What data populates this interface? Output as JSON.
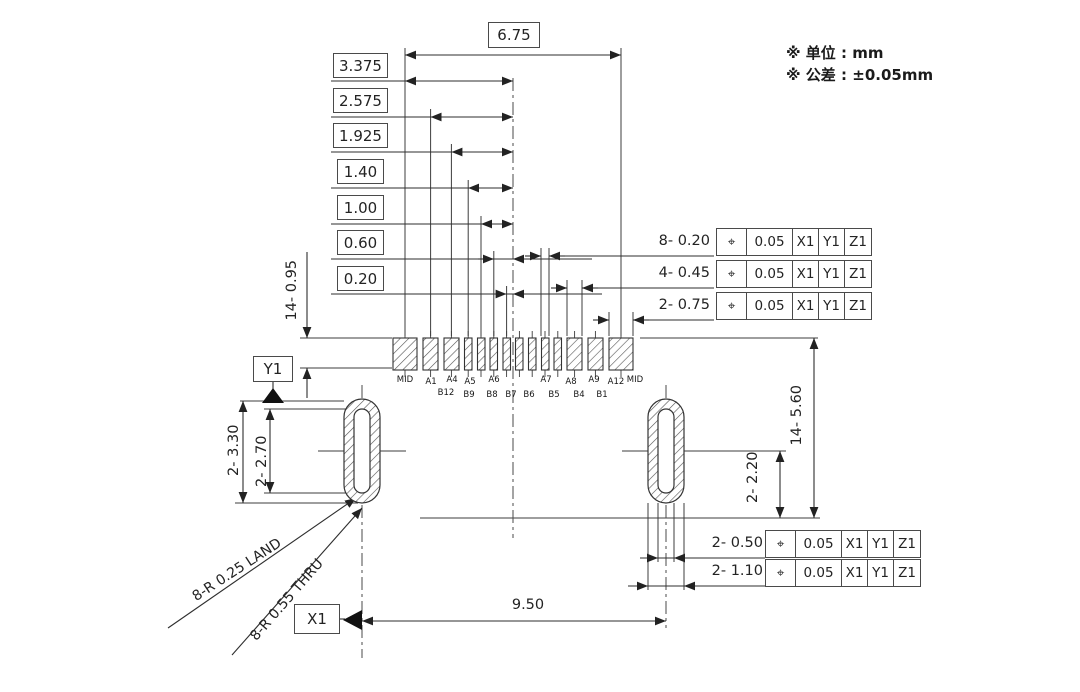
{
  "notes": {
    "unit": "※ 单位 : mm",
    "tolerance": "※ 公差 : ±0.05mm"
  },
  "dims": {
    "top_width": "6.75",
    "stack": [
      "3.375",
      "2.575",
      "1.925",
      "1.40",
      "1.00",
      "0.60",
      "0.20"
    ],
    "pad_length": "14- 0.95",
    "slot_outer_length": "2- 3.30",
    "slot_inner_length": "2- 2.70",
    "right_span": "14- 5.60",
    "slot_center_offset": "2- 2.20",
    "slot_pitch": "9.50"
  },
  "datums": {
    "x": "X1",
    "y": "Y1"
  },
  "leaders": {
    "land": "8-R 0.25 LAND",
    "thru": "8-R 0.55 THRU"
  },
  "frames": {
    "pad_widths": [
      {
        "label": "8- 0.20",
        "symbol": "⌖",
        "tolerance": "0.05",
        "datums": [
          "X1",
          "Y1",
          "Z1"
        ]
      },
      {
        "label": "4- 0.45",
        "symbol": "⌖",
        "tolerance": "0.05",
        "datums": [
          "X1",
          "Y1",
          "Z1"
        ]
      },
      {
        "label": "2- 0.75",
        "symbol": "⌖",
        "tolerance": "0.05",
        "datums": [
          "X1",
          "Y1",
          "Z1"
        ]
      }
    ],
    "slot_widths": [
      {
        "label": "2- 0.50",
        "symbol": "⌖",
        "tolerance": "0.05",
        "datums": [
          "X1",
          "Y1",
          "Z1"
        ]
      },
      {
        "label": "2- 1.10",
        "symbol": "⌖",
        "tolerance": "0.05",
        "datums": [
          "X1",
          "Y1",
          "Z1"
        ]
      }
    ]
  },
  "pins": {
    "top": [
      "MID",
      "A1",
      "A4",
      "A5",
      "A6",
      "A7",
      "A8",
      "A9",
      "A12",
      "MID"
    ],
    "bottom": [
      "B12",
      "B9",
      "B8",
      "B7",
      "B6",
      "B5",
      "B4",
      "B1"
    ]
  }
}
